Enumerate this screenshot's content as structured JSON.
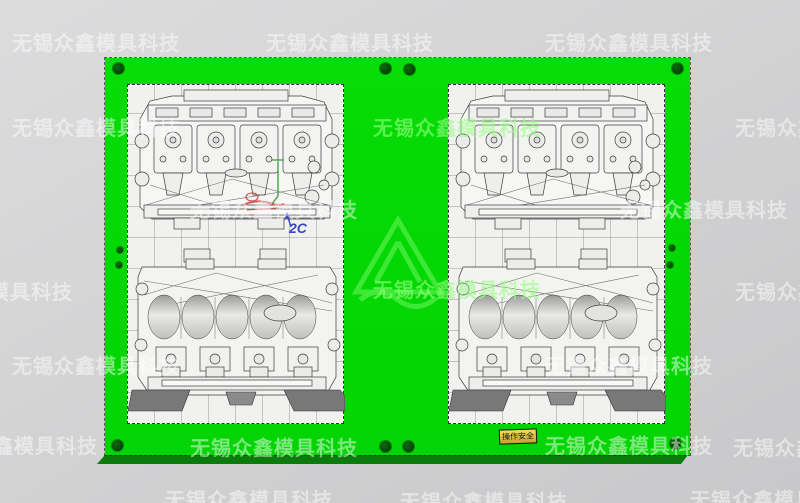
{
  "watermark": {
    "text": "无锡众鑫模具科技",
    "instances": [
      {
        "x": 12,
        "y": 27
      },
      {
        "x": 266,
        "y": 27
      },
      {
        "x": 545,
        "y": 27
      },
      {
        "x": 12,
        "y": 112
      },
      {
        "x": 373,
        "y": 112,
        "bright": true
      },
      {
        "x": 735,
        "y": 112
      },
      {
        "x": 190,
        "y": 194
      },
      {
        "x": 620,
        "y": 194
      },
      {
        "x": -95,
        "y": 276
      },
      {
        "x": 373,
        "y": 274,
        "bright": true
      },
      {
        "x": 735,
        "y": 276
      },
      {
        "x": 12,
        "y": 350
      },
      {
        "x": 545,
        "y": 350
      },
      {
        "x": -70,
        "y": 430
      },
      {
        "x": 190,
        "y": 432
      },
      {
        "x": 545,
        "y": 430
      },
      {
        "x": 733,
        "y": 432
      },
      {
        "x": 165,
        "y": 484
      },
      {
        "x": 400,
        "y": 486
      },
      {
        "x": 690,
        "y": 484
      }
    ]
  },
  "annotations": {
    "label_2c": "2C"
  },
  "safety_tag": {
    "text": "操作安全",
    "bg": "#e3cf3b"
  },
  "colors": {
    "background": "#d2d2d3",
    "plate_green": "#03d403",
    "plate_side_green": "#0b7c0b",
    "hole_green": "#0a5c0a",
    "wireframe": "#3c3c3c",
    "insert_bg": "#f1f1f0",
    "annotation_red": "#cc5050",
    "annotation_blue": "#3946c8",
    "annotation_green": "#3f9b3f"
  },
  "plate": {
    "holes_large": [
      [
        118,
        68
      ],
      [
        677,
        68
      ],
      [
        385,
        68
      ],
      [
        409,
        69
      ],
      [
        117,
        445
      ],
      [
        675,
        443
      ],
      [
        385,
        446
      ],
      [
        408,
        446
      ]
    ],
    "holes_small": [
      [
        120,
        250
      ],
      [
        119,
        265
      ],
      [
        672,
        248
      ],
      [
        670,
        265
      ]
    ]
  },
  "inserts": [
    {
      "id": "left-cavity"
    },
    {
      "id": "right-cavity"
    }
  ]
}
